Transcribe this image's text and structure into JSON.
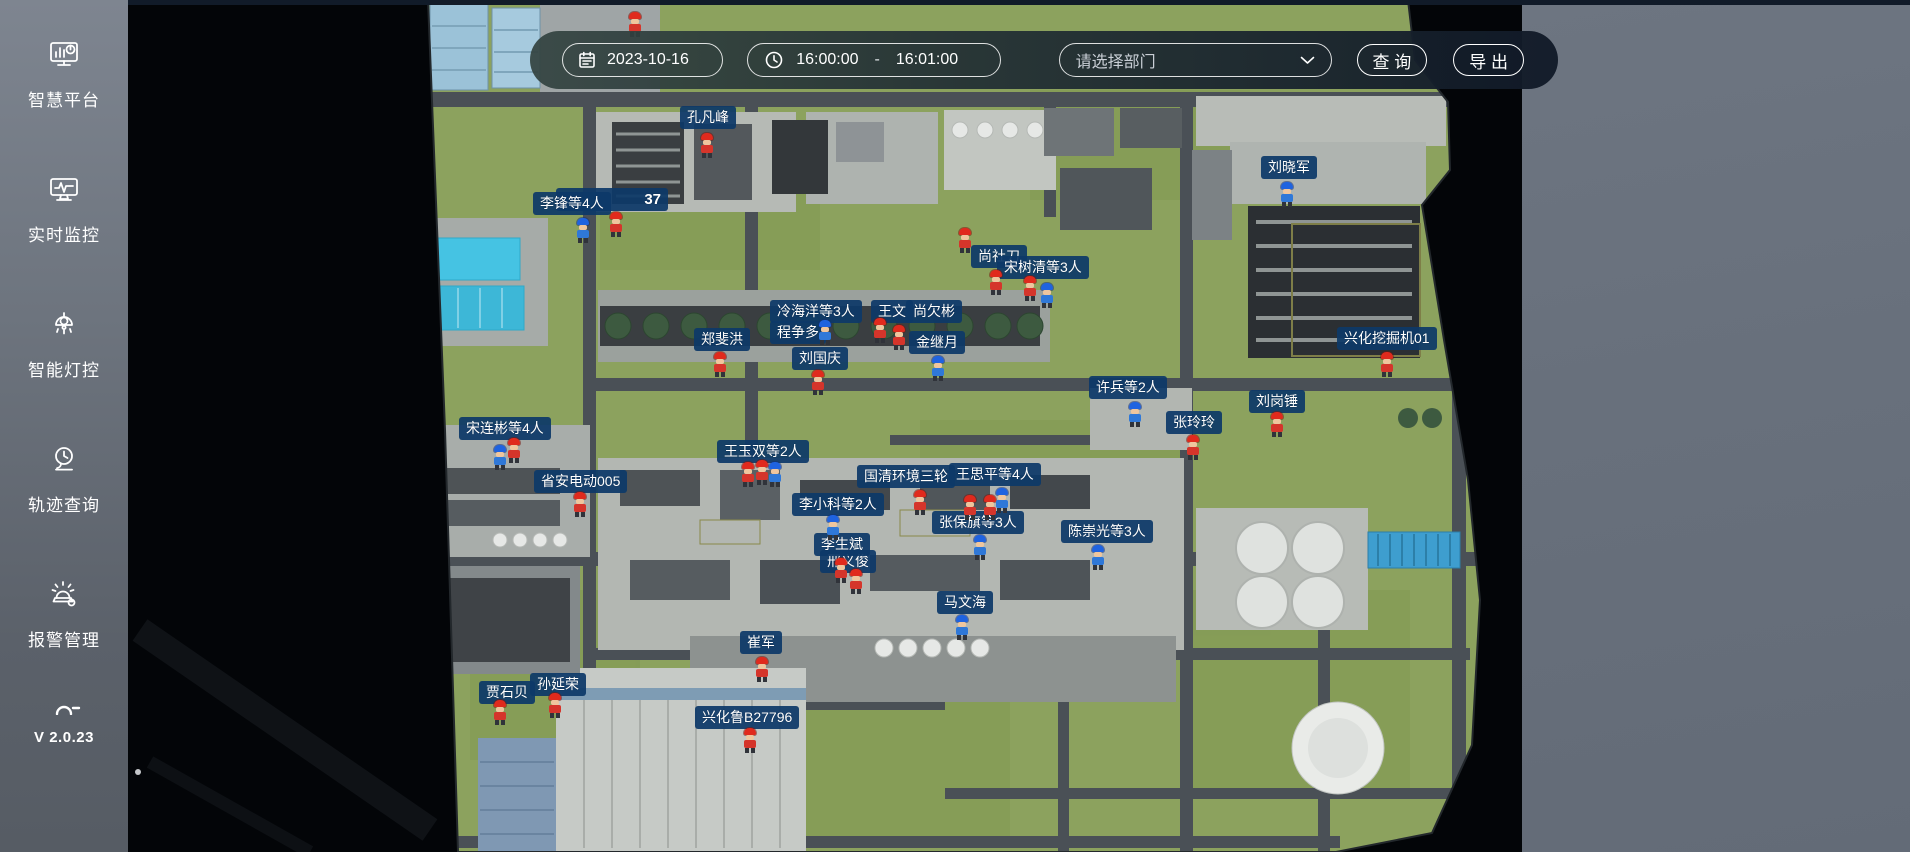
{
  "sidebar": {
    "items": [
      {
        "label": "智慧平台",
        "icon": "dashboard-monitor-icon"
      },
      {
        "label": "实时监控",
        "icon": "realtime-monitor-icon"
      },
      {
        "label": "智能灯控",
        "icon": "smart-lamp-icon"
      },
      {
        "label": "轨迹查询",
        "icon": "trajectory-camera-icon"
      },
      {
        "label": "报警管理",
        "icon": "alarm-siren-icon"
      }
    ],
    "version": "V 2.0.23"
  },
  "toolbar": {
    "date_value": "2023-10-16",
    "time_start": "16:00:00",
    "time_separator": "-",
    "time_end": "16:01:00",
    "department_placeholder": "请选择部门",
    "query_label": "查 询",
    "export_label": "导 出"
  },
  "map": {
    "colors": {
      "label_bg": "#0d3968",
      "helmet_red": "#e02a1d",
      "helmet_blue": "#1f63e0",
      "grass": "#8ca25e",
      "road": "#4a5056",
      "empty_panel": "#68707c"
    },
    "labels": [
      {
        "text": "孔凡峰",
        "x": 680,
        "y": 106
      },
      {
        "text": "37",
        "x": 556,
        "y": 188,
        "w": 112,
        "kind": "count"
      },
      {
        "text": "李锋等4人",
        "x": 533,
        "y": 192
      },
      {
        "text": "刘晓军",
        "x": 1261,
        "y": 156
      },
      {
        "text": "尚社刀",
        "x": 971,
        "y": 245
      },
      {
        "text": "宋树清等3人",
        "x": 997,
        "y": 256
      },
      {
        "text": "冷海洋等3人",
        "x": 770,
        "y": 300
      },
      {
        "text": "王文",
        "x": 871,
        "y": 300
      },
      {
        "text": "尚欠彬",
        "x": 906,
        "y": 300
      },
      {
        "text": "程争多",
        "x": 770,
        "y": 321
      },
      {
        "text": "郑斐洪",
        "x": 694,
        "y": 328
      },
      {
        "text": "金继月",
        "x": 909,
        "y": 331
      },
      {
        "text": "刘国庆",
        "x": 792,
        "y": 347
      },
      {
        "text": "兴化挖掘机01",
        "x": 1337,
        "y": 327
      },
      {
        "text": "许兵等2人",
        "x": 1089,
        "y": 376
      },
      {
        "text": "刘岗锤",
        "x": 1249,
        "y": 390
      },
      {
        "text": "张玲玲",
        "x": 1166,
        "y": 411
      },
      {
        "text": "宋连彬等4人",
        "x": 459,
        "y": 417
      },
      {
        "text": "王玉双等2人",
        "x": 717,
        "y": 440
      },
      {
        "text": "王思平等4人",
        "x": 949,
        "y": 463
      },
      {
        "text": "国清环境三轮",
        "x": 857,
        "y": 465
      },
      {
        "text": "省安电动005",
        "x": 534,
        "y": 470
      },
      {
        "text": "李小科等2人",
        "x": 792,
        "y": 493
      },
      {
        "text": "张保旗等3人",
        "x": 932,
        "y": 511
      },
      {
        "text": "陈崇光等3人",
        "x": 1061,
        "y": 520
      },
      {
        "text": "邢义俊",
        "x": 820,
        "y": 550
      },
      {
        "text": "李生斌",
        "x": 814,
        "y": 533
      },
      {
        "text": "马文海",
        "x": 937,
        "y": 591
      },
      {
        "text": "崔军",
        "x": 740,
        "y": 631
      },
      {
        "text": "贾石贝",
        "x": 479,
        "y": 681
      },
      {
        "text": "孙延荣",
        "x": 530,
        "y": 673
      },
      {
        "text": "兴化鲁B27796",
        "x": 695,
        "y": 706
      }
    ],
    "workers": [
      {
        "c": "red",
        "x": 707,
        "y": 133
      },
      {
        "c": "blue",
        "x": 583,
        "y": 218
      },
      {
        "c": "red",
        "x": 616,
        "y": 212
      },
      {
        "c": "red",
        "x": 635,
        "y": 12
      },
      {
        "c": "blue",
        "x": 1287,
        "y": 182
      },
      {
        "c": "red",
        "x": 996,
        "y": 270
      },
      {
        "c": "red",
        "x": 1030,
        "y": 276
      },
      {
        "c": "blue",
        "x": 1047,
        "y": 283
      },
      {
        "c": "red",
        "x": 965,
        "y": 228
      },
      {
        "c": "blue",
        "x": 825,
        "y": 320
      },
      {
        "c": "red",
        "x": 880,
        "y": 318
      },
      {
        "c": "red",
        "x": 899,
        "y": 325
      },
      {
        "c": "blue",
        "x": 938,
        "y": 356
      },
      {
        "c": "red",
        "x": 720,
        "y": 352
      },
      {
        "c": "red",
        "x": 818,
        "y": 370
      },
      {
        "c": "red",
        "x": 1387,
        "y": 352
      },
      {
        "c": "blue",
        "x": 1135,
        "y": 402
      },
      {
        "c": "red",
        "x": 1277,
        "y": 412
      },
      {
        "c": "red",
        "x": 1193,
        "y": 435
      },
      {
        "c": "blue",
        "x": 500,
        "y": 445
      },
      {
        "c": "red",
        "x": 514,
        "y": 438
      },
      {
        "c": "red",
        "x": 580,
        "y": 492
      },
      {
        "c": "red",
        "x": 748,
        "y": 462
      },
      {
        "c": "red",
        "x": 762,
        "y": 460
      },
      {
        "c": "blue",
        "x": 775,
        "y": 462
      },
      {
        "c": "red",
        "x": 920,
        "y": 490
      },
      {
        "c": "red",
        "x": 970,
        "y": 495
      },
      {
        "c": "red",
        "x": 990,
        "y": 495
      },
      {
        "c": "blue",
        "x": 1002,
        "y": 488
      },
      {
        "c": "blue",
        "x": 833,
        "y": 515
      },
      {
        "c": "blue",
        "x": 980,
        "y": 535
      },
      {
        "c": "blue",
        "x": 1098,
        "y": 545
      },
      {
        "c": "red",
        "x": 841,
        "y": 558
      },
      {
        "c": "red",
        "x": 856,
        "y": 569
      },
      {
        "c": "blue",
        "x": 962,
        "y": 615
      },
      {
        "c": "red",
        "x": 762,
        "y": 657
      },
      {
        "c": "red",
        "x": 500,
        "y": 700
      },
      {
        "c": "red",
        "x": 555,
        "y": 693
      },
      {
        "c": "red",
        "x": 750,
        "y": 728
      }
    ]
  }
}
